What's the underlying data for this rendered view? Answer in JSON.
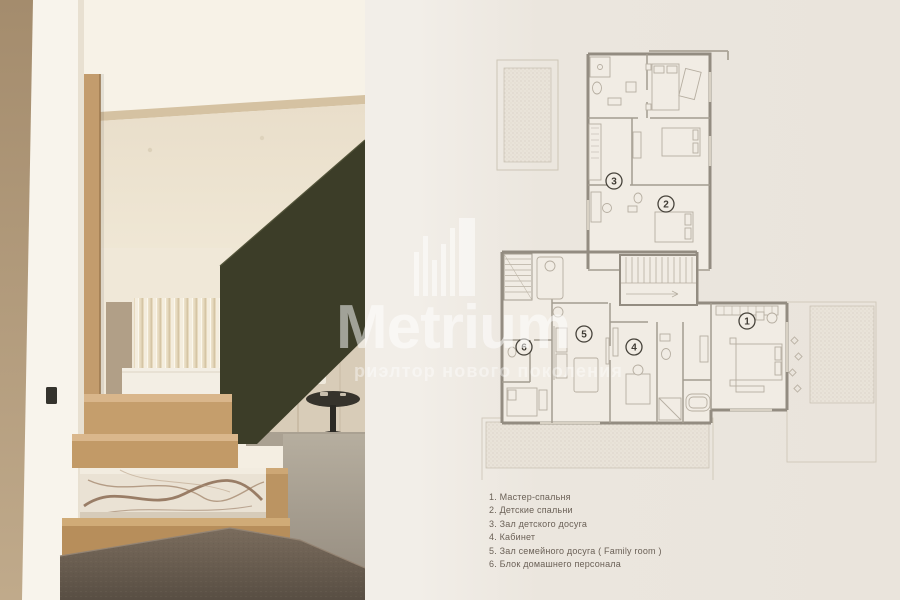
{
  "watermark": {
    "brand": "Metrium",
    "tagline": "риэлтор нового поколения"
  },
  "legend": {
    "items": [
      "1. Мастер-спальня",
      "2. Детские спальни",
      "3. Зал детского досуга",
      "4. Кабинет",
      "5. Зал семейного досуга ( Family room )",
      "6. Блок домашнего персонала"
    ]
  },
  "plan": {
    "room_numbers": [
      "1",
      "2",
      "3",
      "4",
      "5",
      "6"
    ]
  },
  "palette": {
    "page_background": "#efeae2",
    "plan_wall": "#938c81",
    "plan_paper": "#f1ece4",
    "terrace_dot": "#ccc4b6",
    "olive_wall": "#3c3d28",
    "oak_wood": "#c49e6e",
    "marble": "#eae2d4",
    "stone_base": "#6b5f53",
    "legend_text": "#6b6157",
    "watermark_white": "#ffffff"
  }
}
